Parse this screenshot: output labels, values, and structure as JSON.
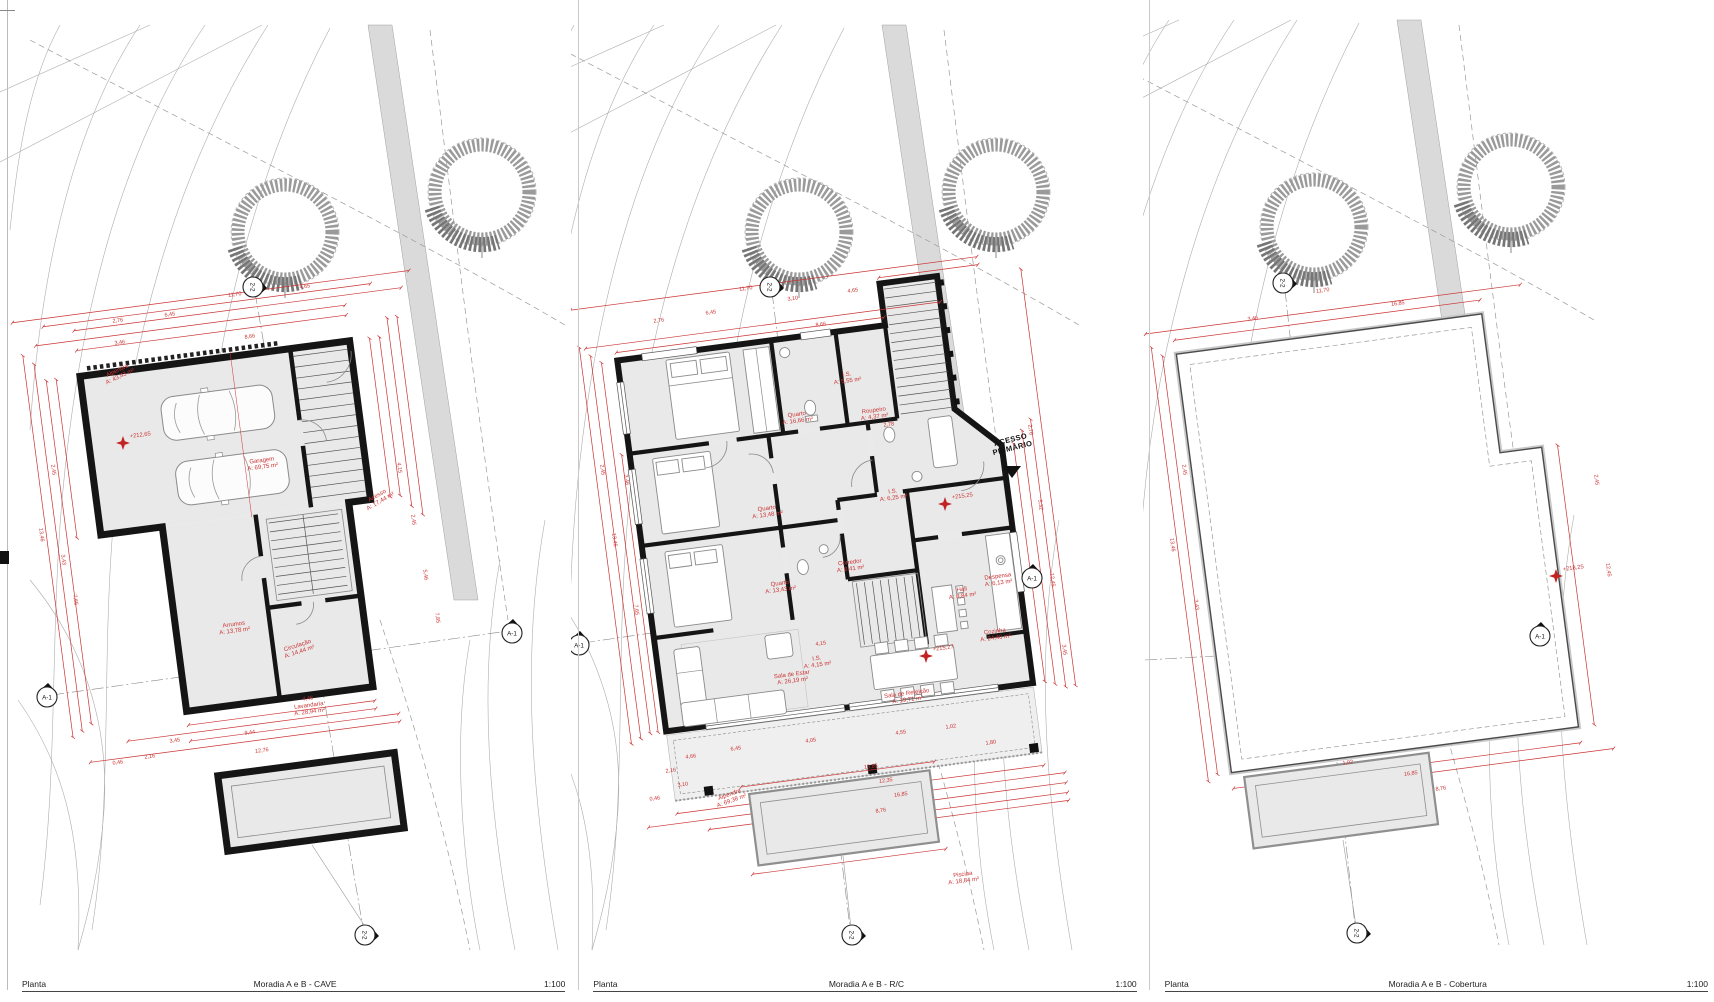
{
  "colors": {
    "annotation_red": "#cc3333",
    "wall_black": "#151515",
    "site_gray": "#9a9a9a"
  },
  "panels": [
    {
      "id": "cave",
      "footer": {
        "type_label": "Planta",
        "title": "Moradia A e B - CAVE",
        "scale": "1:100"
      },
      "rooms": [
        {
          "label": "Alpendre",
          "area": "A: 43,43 m²",
          "x": 118,
          "y": 372,
          "rot": -25
        },
        {
          "label": "Garagem",
          "area": "A: 69,75 m²",
          "x": 262,
          "y": 462
        },
        {
          "label": "Acesso",
          "area": "A: 17,44 m²",
          "x": 378,
          "y": 497,
          "rot": -30
        },
        {
          "label": "Arrumos",
          "area": "A: 13,78 m²",
          "x": 234,
          "y": 626
        },
        {
          "label": "Circulação",
          "area": "A: 14,44 m²",
          "x": 298,
          "y": 647,
          "rot": -18
        },
        {
          "label": "Lavandaria",
          "area": "A: 28,94 m²",
          "x": 309,
          "y": 707
        }
      ],
      "levels": [
        {
          "t": "+212,65",
          "x": 123,
          "y": 443
        }
      ],
      "markers": [
        {
          "label": "A-1",
          "x": 47,
          "y": 697,
          "rot": 0
        },
        {
          "label": "2-2",
          "x": 253,
          "y": 287,
          "rot": 90
        },
        {
          "label": "A-1",
          "x": 512,
          "y": 633,
          "rot": 0
        },
        {
          "label": "2-2",
          "x": 365,
          "y": 935,
          "rot": 90
        }
      ],
      "dims": [
        {
          "t": "2,76",
          "x": 118,
          "y": 322
        },
        {
          "t": "6,45",
          "x": 170,
          "y": 316
        },
        {
          "t": "11,70",
          "x": 235,
          "y": 296
        },
        {
          "t": "4,65",
          "x": 305,
          "y": 288
        },
        {
          "t": "8,66",
          "x": 250,
          "y": 338
        },
        {
          "t": "3,46",
          "x": 120,
          "y": 344
        },
        {
          "t": "13,46",
          "x": 40,
          "y": 535,
          "r": 82.5
        },
        {
          "t": "2,45",
          "x": 52,
          "y": 470,
          "r": 82.5
        },
        {
          "t": "3,43",
          "x": 62,
          "y": 560,
          "r": 82.5
        },
        {
          "t": "7,65",
          "x": 74,
          "y": 600,
          "r": 82.5
        },
        {
          "t": "4,15",
          "x": 398,
          "y": 468,
          "r": 82.5
        },
        {
          "t": "2,45",
          "x": 412,
          "y": 520,
          "r": 82.5
        },
        {
          "t": "5,46",
          "x": 424,
          "y": 575,
          "r": 82.5
        },
        {
          "t": "7,85",
          "x": 436,
          "y": 618,
          "r": 82.5
        },
        {
          "t": "9,44",
          "x": 250,
          "y": 734
        },
        {
          "t": "3,45",
          "x": 175,
          "y": 742
        },
        {
          "t": "12,76",
          "x": 262,
          "y": 752
        },
        {
          "t": "2,16",
          "x": 150,
          "y": 758
        },
        {
          "t": "0,46",
          "x": 118,
          "y": 764
        },
        {
          "t": "4,46",
          "x": 308,
          "y": 700
        }
      ]
    },
    {
      "id": "rc",
      "footer": {
        "type_label": "Planta",
        "title": "Moradia A e B - R/C",
        "scale": "1:100"
      },
      "access_note": {
        "lines": [
          "ACESSO",
          "PRIMÁRIO"
        ],
        "x": 440,
        "y": 442,
        "rot": -14,
        "tri": {
          "x": 441,
          "y": 466
        }
      },
      "rooms": [
        {
          "label": "Quarto",
          "area": "A: 16,66 m²",
          "x": 226,
          "y": 416
        },
        {
          "label": "I.S.",
          "area": "A: 5,55 m²",
          "x": 276,
          "y": 376
        },
        {
          "label": "Roupeiro",
          "area": "A: 4,37 m²",
          "x": 303,
          "y": 412
        },
        {
          "label": "Quarto",
          "area": "A: 13,48 m²",
          "x": 196,
          "y": 510
        },
        {
          "label": "Quarto",
          "area": "A: 13,43 m²",
          "x": 209,
          "y": 585
        },
        {
          "label": "I.S.",
          "area": "A: 4,15 m²",
          "x": 246,
          "y": 660
        },
        {
          "label": "I.S.",
          "area": "A: 6,25 m²",
          "x": 322,
          "y": 493
        },
        {
          "label": "Corredor",
          "area": "A: 8,41 m²",
          "x": 279,
          "y": 564
        },
        {
          "label": "Hall",
          "area": "A: 8,84 m²",
          "x": 391,
          "y": 591
        },
        {
          "label": "Despensa",
          "area": "A: 6,13 m²",
          "x": 427,
          "y": 578
        },
        {
          "label": "Cozinha",
          "area": "A: 24,46 m²",
          "x": 424,
          "y": 633
        },
        {
          "label": "Sala de Estar",
          "area": "A: 26,19 m²",
          "x": 221,
          "y": 676
        },
        {
          "label": "Sala de Refeição",
          "area": "A: 19,71 m²",
          "x": 336,
          "y": 695
        },
        {
          "label": "Alpendre",
          "area": "A: 69,38 m²",
          "x": 159,
          "y": 796,
          "rot": -20
        },
        {
          "label": "Piscina",
          "area": "A: 18,84 m²",
          "x": 392,
          "y": 876
        }
      ],
      "levels": [
        {
          "t": "+215,25",
          "x": 374,
          "y": 504
        },
        {
          "t": "+215,27",
          "x": 355,
          "y": 656
        }
      ],
      "markers": [
        {
          "label": "A-1",
          "x": 8,
          "y": 645,
          "rot": 0
        },
        {
          "label": "2-2",
          "x": 199,
          "y": 287,
          "rot": 90
        },
        {
          "label": "A-1",
          "x": 461,
          "y": 578,
          "rot": 0
        },
        {
          "label": "2-2",
          "x": 281,
          "y": 935,
          "rot": 90
        }
      ],
      "dims": [
        {
          "t": "11,70",
          "x": 175,
          "y": 290
        },
        {
          "t": "2,76",
          "x": 88,
          "y": 322
        },
        {
          "t": "6,45",
          "x": 140,
          "y": 314
        },
        {
          "t": "3,10",
          "x": 222,
          "y": 300
        },
        {
          "t": "4,65",
          "x": 282,
          "y": 292
        },
        {
          "t": "8,66",
          "x": 250,
          "y": 326
        },
        {
          "t": "2,45",
          "x": 30,
          "y": 470,
          "r": 82.5
        },
        {
          "t": "13,46",
          "x": 42,
          "y": 540,
          "r": 82.5
        },
        {
          "t": "3,46",
          "x": 54,
          "y": 480,
          "r": 82.5
        },
        {
          "t": "7,65",
          "x": 64,
          "y": 610,
          "r": 82.5
        },
        {
          "t": "2,76",
          "x": 458,
          "y": 430,
          "r": 82.5
        },
        {
          "t": "5,32",
          "x": 468,
          "y": 505,
          "r": 82.5
        },
        {
          "t": "12,45",
          "x": 480,
          "y": 580,
          "r": 82.5
        },
        {
          "t": "3,45",
          "x": 492,
          "y": 650,
          "r": 82.5
        },
        {
          "t": "4,66",
          "x": 120,
          "y": 758
        },
        {
          "t": "6,45",
          "x": 165,
          "y": 750
        },
        {
          "t": "4,05",
          "x": 240,
          "y": 742
        },
        {
          "t": "4,55",
          "x": 330,
          "y": 734
        },
        {
          "t": "1,02",
          "x": 380,
          "y": 728
        },
        {
          "t": "13,85",
          "x": 300,
          "y": 768
        },
        {
          "t": "12,35",
          "x": 315,
          "y": 782
        },
        {
          "t": "16,85",
          "x": 330,
          "y": 796
        },
        {
          "t": "8,76",
          "x": 310,
          "y": 812
        },
        {
          "t": "2,16",
          "x": 100,
          "y": 772
        },
        {
          "t": "3,10",
          "x": 112,
          "y": 786
        },
        {
          "t": "0,46",
          "x": 84,
          "y": 800
        },
        {
          "t": "1,80",
          "x": 420,
          "y": 744
        },
        {
          "t": "4,15",
          "x": 250,
          "y": 645
        },
        {
          "t": "2,78",
          "x": 318,
          "y": 426
        }
      ]
    },
    {
      "id": "cobertura",
      "footer": {
        "type_label": "Planta",
        "title": "Moradia A e B - Cobertura",
        "scale": "1:100"
      },
      "rooms": [],
      "levels": [
        {
          "t": "+218,25",
          "x": 413,
          "y": 576
        }
      ],
      "markers": [
        {
          "label": "2-2",
          "x": 140,
          "y": 283,
          "rot": 90
        },
        {
          "label": "A-1",
          "x": 397,
          "y": 636,
          "rot": 0
        },
        {
          "label": "2-2",
          "x": 214,
          "y": 933,
          "rot": 90
        }
      ],
      "dims": [
        {
          "t": "11,70",
          "x": 180,
          "y": 292
        },
        {
          "t": "16,85",
          "x": 255,
          "y": 305
        },
        {
          "t": "3,46",
          "x": 110,
          "y": 320
        },
        {
          "t": "13,46",
          "x": 28,
          "y": 545,
          "r": 82.5
        },
        {
          "t": "2,45",
          "x": 40,
          "y": 470,
          "r": 82.5
        },
        {
          "t": "3,43",
          "x": 52,
          "y": 605,
          "r": 82.5
        },
        {
          "t": "2,45",
          "x": 452,
          "y": 480,
          "r": 82.5
        },
        {
          "t": "12,45",
          "x": 464,
          "y": 570,
          "r": 82.5
        },
        {
          "t": "16,85",
          "x": 268,
          "y": 775
        },
        {
          "t": "8,76",
          "x": 298,
          "y": 790
        },
        {
          "t": "1,02",
          "x": 205,
          "y": 764
        }
      ]
    }
  ]
}
